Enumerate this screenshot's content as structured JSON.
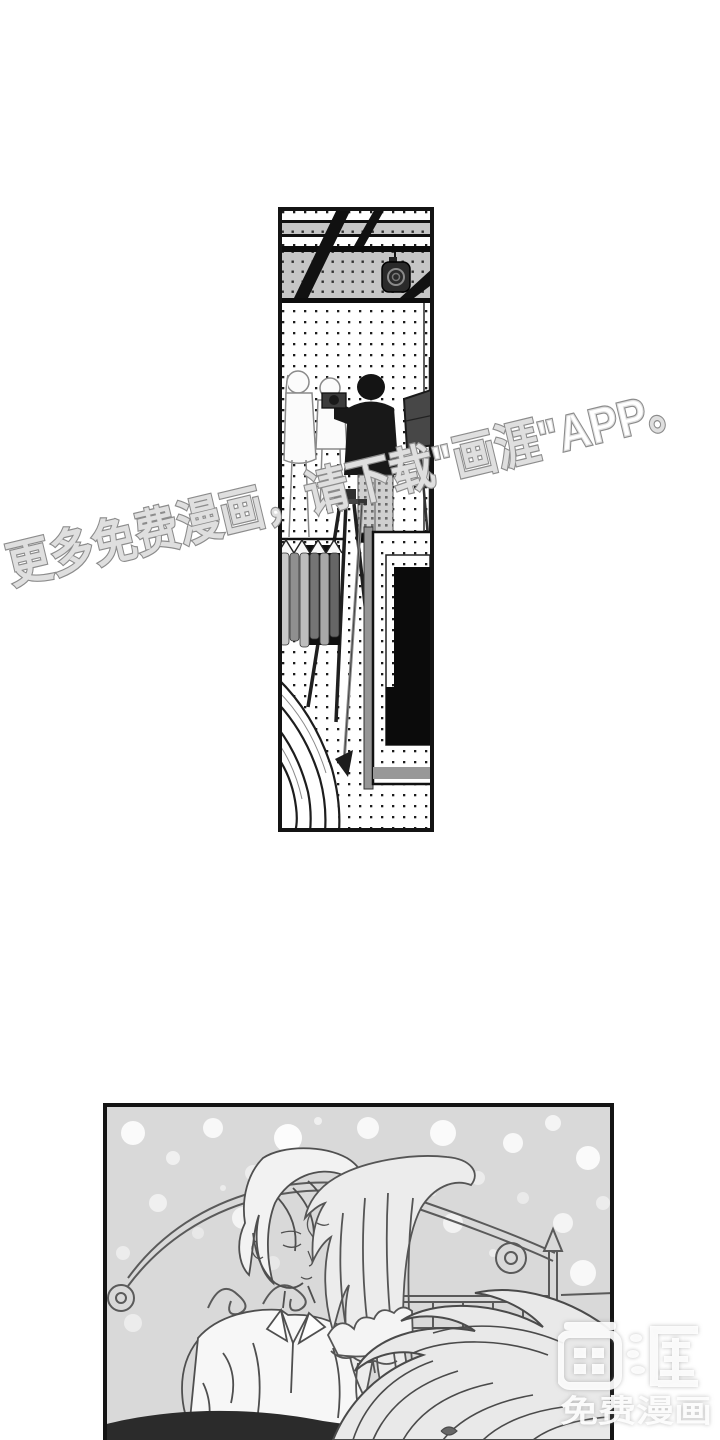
{
  "watermark": {
    "text": "更多免费漫画，请下载\"画涯\"APP。",
    "outline_color": "#8c8c8c",
    "fill_color": "#ffffff"
  },
  "logo": {
    "brand": "画涯",
    "tagline": "免费漫画",
    "color": "#ffffff"
  },
  "panels": {
    "studio": {
      "description": "photo-studio manga panel"
    },
    "bedroom": {
      "description": "couple-on-bed manga panel"
    }
  },
  "colors": {
    "page_bg": "#ffffff",
    "panel_border": "#141414",
    "screentone_dot": "#1c1c1c",
    "bedroom_bg": "#d9d9d9"
  }
}
